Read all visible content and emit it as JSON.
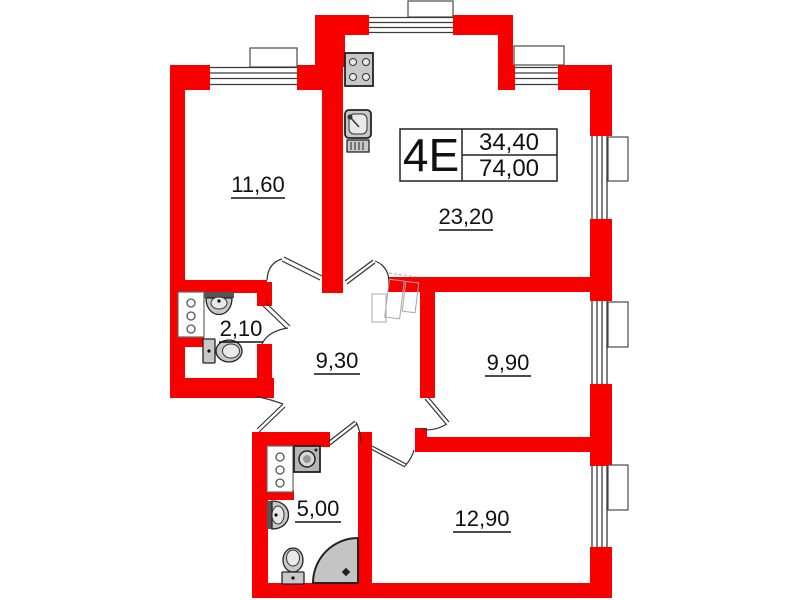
{
  "title_block": {
    "unit_type": "4E",
    "upper_value": "34,40",
    "lower_value": "74,00"
  },
  "rooms": [
    {
      "area": "11,60"
    },
    {
      "area": "23,20"
    },
    {
      "area": "2,10"
    },
    {
      "area": "9,30"
    },
    {
      "area": "9,90"
    },
    {
      "area": "5,00"
    },
    {
      "area": "12,90"
    }
  ],
  "colors": {
    "wall": "#f80000",
    "fixture": "#c8c8c8",
    "line": "#2b2b2b"
  },
  "icons": [
    "stove-icon",
    "kitchen-sink-icon",
    "washbasin-icon",
    "toilet-icon",
    "washing-machine-icon",
    "corner-shower-icon",
    "ventilation-shaft-icon",
    "window-icon",
    "door-arc-icon",
    "closet-icon"
  ]
}
